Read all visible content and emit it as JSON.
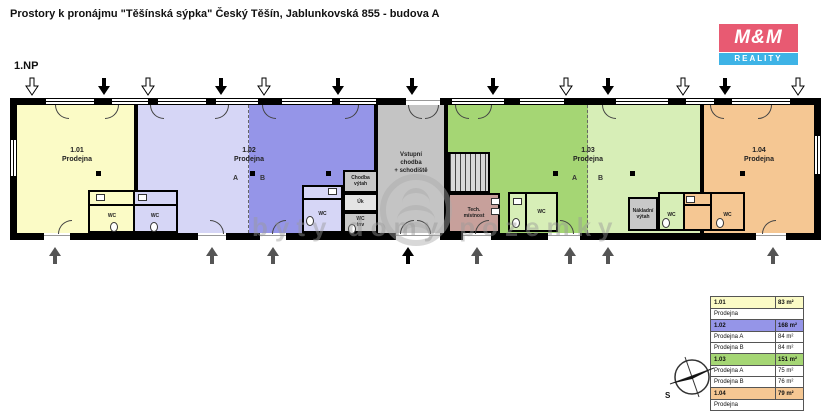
{
  "title": "Prostory k pronájmu \"Těšínská sýpka\" Český Těšín, Jablunkovská 855 - budova A",
  "floor_label": "1.NP",
  "logo": {
    "line1": "M&M",
    "line2": "REALITY",
    "red": "#e85a72",
    "blue": "#3eb3e6"
  },
  "watermark": "byty domy pozemky",
  "compass": {
    "north_label": "S"
  },
  "colors": {
    "r101": "#fbfbc6",
    "r102a": "#d6d6f6",
    "r102b": "#9595e8",
    "entrance": "#c4c4c4",
    "r103a": "#a5d674",
    "r103b": "#d7eeb7",
    "r104": "#f5c793",
    "tech": "#c7a09b",
    "elevator": "#c8c8c8",
    "wall": "#000000"
  },
  "rooms": {
    "r101": {
      "num": "1.01",
      "name": "Prodejna"
    },
    "r102": {
      "num": "1.02",
      "name": "Prodejna",
      "a": "A",
      "b": "B"
    },
    "entrance": {
      "line1": "Vstupní",
      "line2": "chodba",
      "line3": "+ schodiště"
    },
    "r103": {
      "num": "1.03",
      "name": "Prodejna",
      "a": "A",
      "b": "B"
    },
    "r104": {
      "num": "1.04",
      "name": "Prodejna"
    },
    "tech": {
      "line1": "Tech.",
      "line2": "místnost"
    },
    "freight_elevator": {
      "line1": "Nákladní",
      "line2": "výtah"
    },
    "corridor_elevator": {
      "line1": "Chodba",
      "line2": "výtah"
    },
    "cleaning_room": "Úk",
    "wc_accessible": {
      "line1": "WC",
      "line2": "inv"
    },
    "wc": "WC"
  },
  "legend": {
    "rows": [
      {
        "label": "1.01",
        "value": "83 m²",
        "color": "#fbfbc6"
      },
      {
        "label": "Prodejna",
        "value": ""
      },
      {
        "label": "1.02",
        "value": "168 m²",
        "color": "#9595e8"
      },
      {
        "label": "Prodejna A",
        "value": "84 m²"
      },
      {
        "label": "Prodejna B",
        "value": "84 m²"
      },
      {
        "label": "1.03",
        "value": "151 m²",
        "color": "#a5d674"
      },
      {
        "label": "Prodejna A",
        "value": "75 m²"
      },
      {
        "label": "Prodejna B",
        "value": "76 m²"
      },
      {
        "label": "1.04",
        "value": "79 m²",
        "color": "#f5c793"
      },
      {
        "label": "Prodejna",
        "value": ""
      }
    ]
  }
}
